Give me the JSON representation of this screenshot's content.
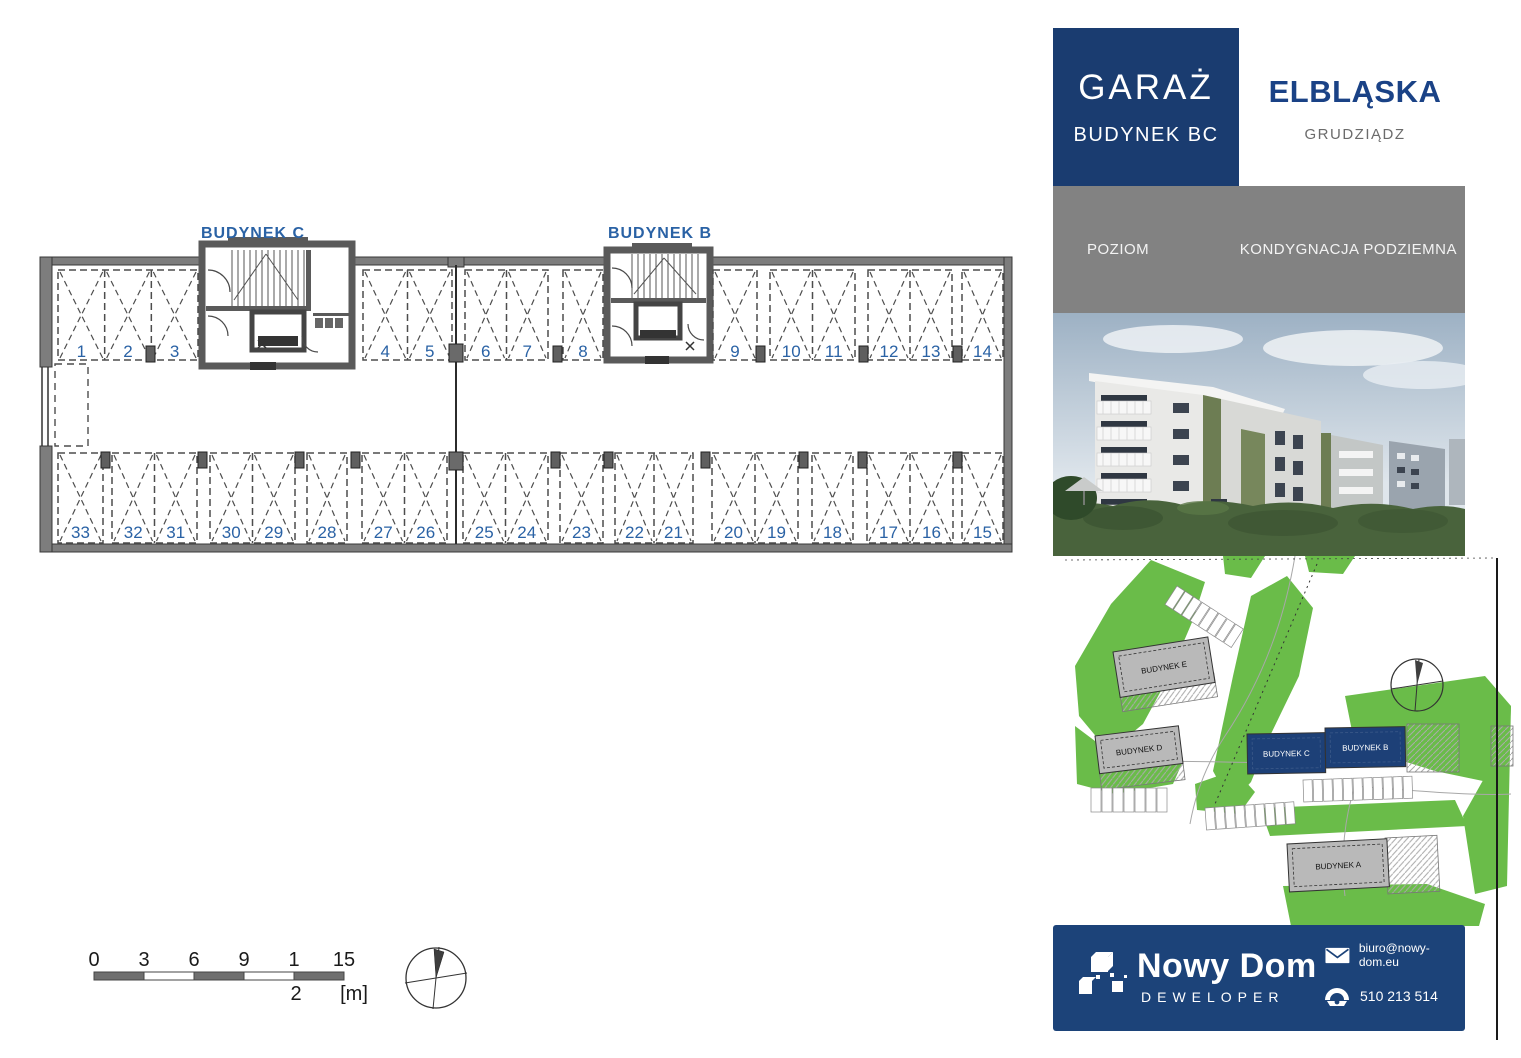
{
  "header": {
    "title": "GARAŻ",
    "subtitle": "BUDYNEK BC",
    "project_name": "ELBLĄSKA",
    "city": "GRUDZIĄDZ",
    "level_label": "POZIOM",
    "level_value": "KONDYGNACJA PODZIEMNA"
  },
  "floor_plan": {
    "building_labels": [
      "BUDYNEK C",
      "BUDYNEK B"
    ],
    "top_row_spots": [
      "1",
      "2",
      "3",
      "4",
      "5",
      "6",
      "7",
      "8",
      "9",
      "10",
      "11",
      "12",
      "13",
      "14"
    ],
    "bottom_row_spots": [
      "33",
      "32",
      "31",
      "30",
      "29",
      "28",
      "27",
      "26",
      "25",
      "24",
      "23",
      "22",
      "21",
      "20",
      "19",
      "18",
      "17",
      "16",
      "15"
    ]
  },
  "scale_bar": {
    "tick_labels": [
      "0",
      "3",
      "6",
      "9",
      "1",
      "15"
    ],
    "wrapped_tick_second_line": "2",
    "unit_label": "[m]"
  },
  "site_plan": {
    "buildings": [
      {
        "label": "BUDYNEK E",
        "highlighted": false
      },
      {
        "label": "BUDYNEK D",
        "highlighted": false
      },
      {
        "label": "BUDYNEK C",
        "highlighted": true
      },
      {
        "label": "BUDYNEK B",
        "highlighted": true
      },
      {
        "label": "BUDYNEK A",
        "highlighted": false
      }
    ]
  },
  "footer": {
    "company_name": "Nowy Dom",
    "company_role": "DEWELOPER",
    "email": "biuro@nowy-dom.eu",
    "phone": "510 213 514"
  },
  "colors": {
    "brand_navy": "#1a3c70",
    "footer_navy": "#1c4379",
    "accent_blue": "#2a62a5",
    "panel_gray": "#828282",
    "site_green": "#6abc49"
  }
}
